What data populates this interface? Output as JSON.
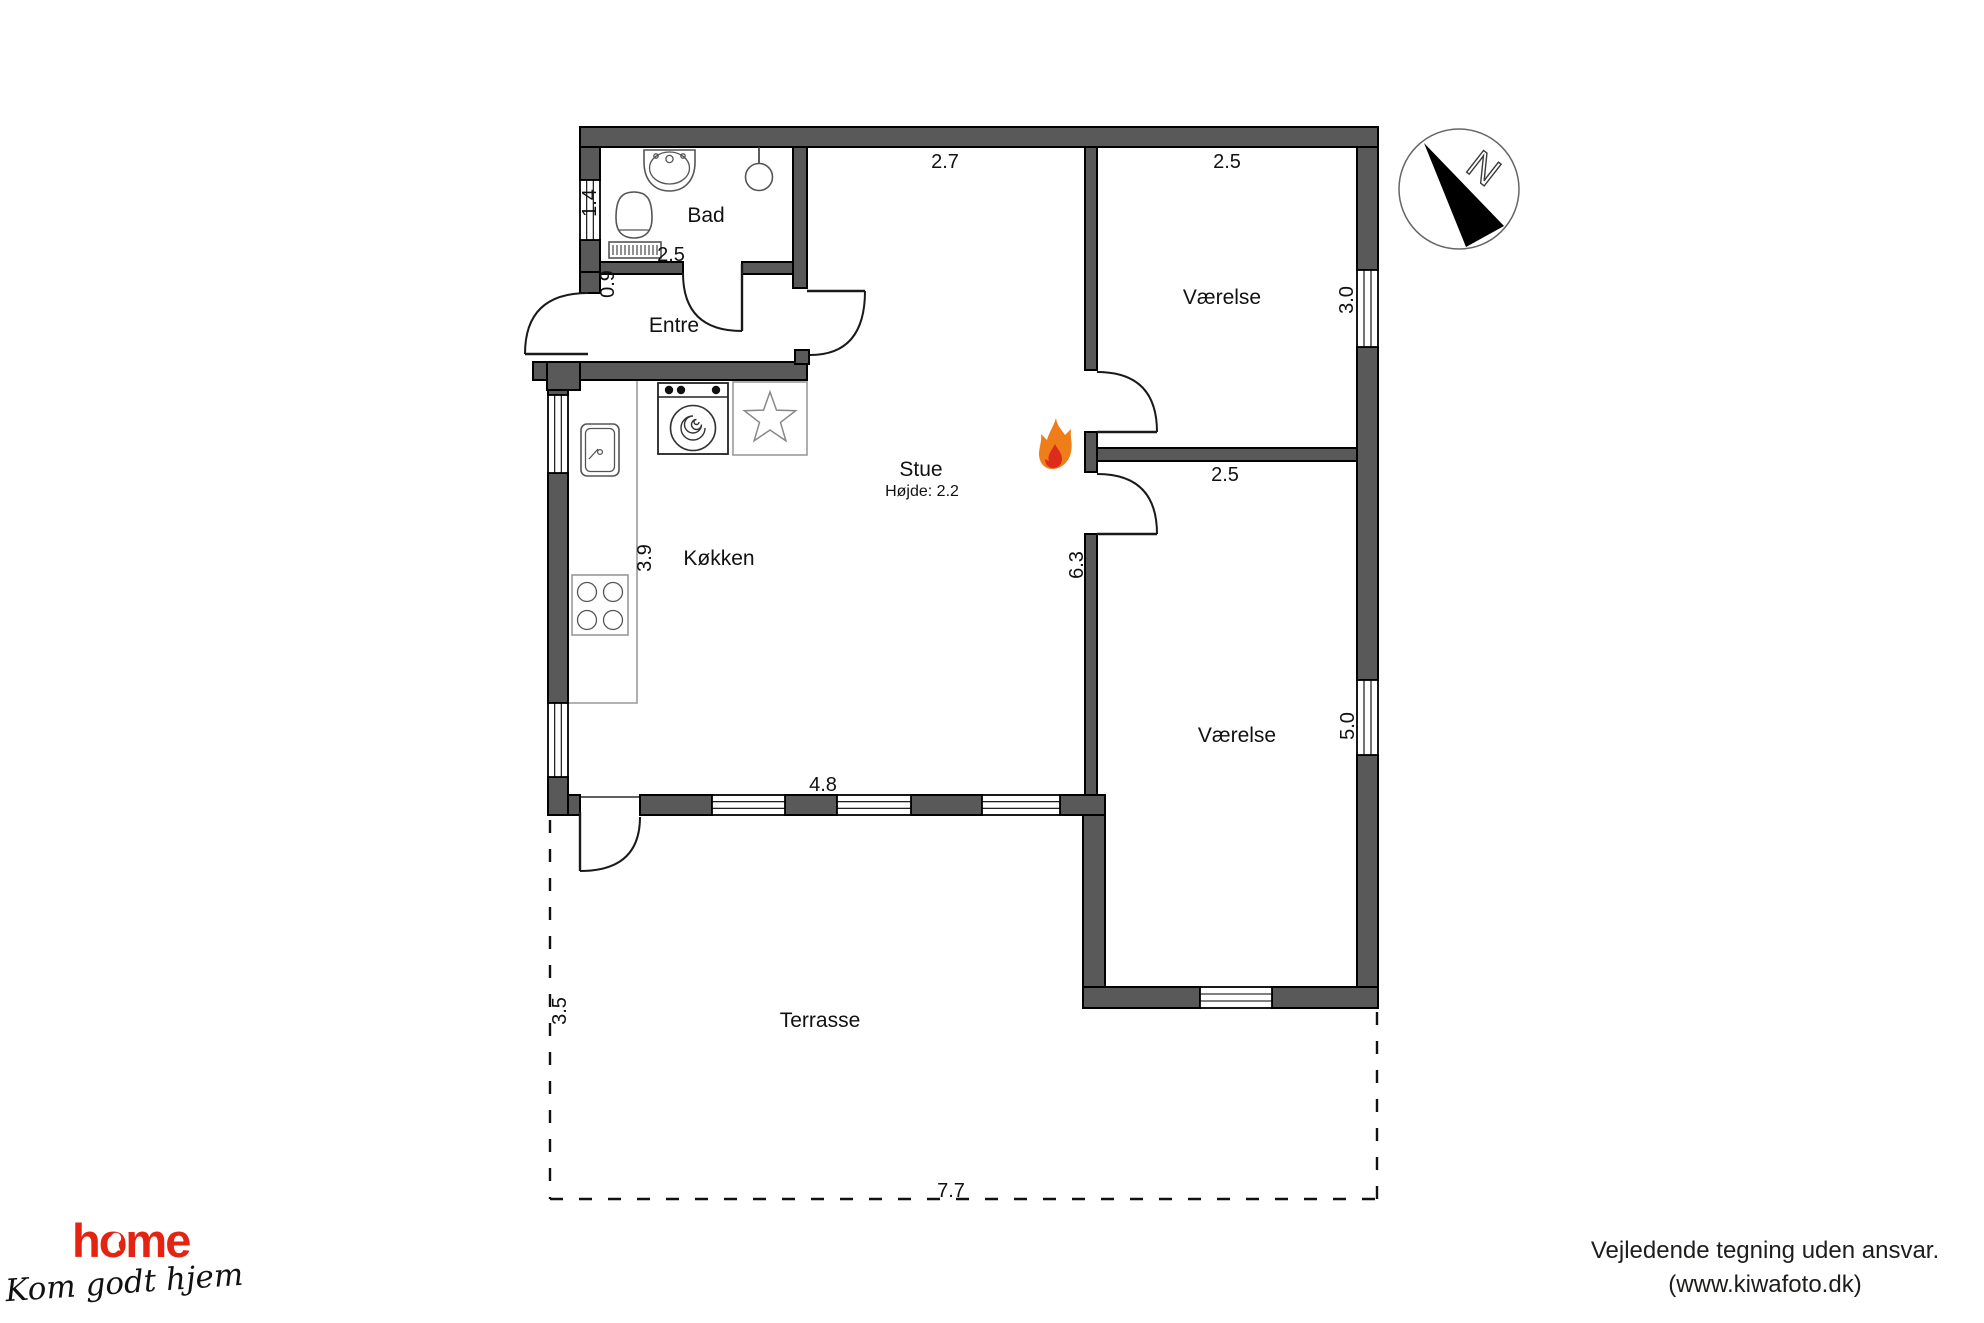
{
  "floor_plan": {
    "rooms": {
      "bad": "Bad",
      "entre": "Entre",
      "kokken": "Køkken",
      "stue": "Stue",
      "stue_height": "Højde: 2.2",
      "vaerelse_top": "Værelse",
      "vaerelse_bottom": "Værelse",
      "terrasse": "Terrasse"
    },
    "dimensions": {
      "stue_width": "2.7",
      "vaerelse_top_width": "2.5",
      "bad_window": "1.4",
      "bad_width": "2.5",
      "entre_door": "0.9",
      "vaerelse_top_depth": "3.0",
      "vaerelse_bottom_width": "2.5",
      "stue_depth": "6.3",
      "kokken_depth": "3.9",
      "vaerelse_bottom_depth": "5.0",
      "kokken_width": "4.8",
      "terrasse_depth": "3.5",
      "terrasse_width": "7.7"
    },
    "compass": {
      "north_label": "N"
    },
    "colors": {
      "wall": "#595959",
      "flame_outer": "#ef7d1a",
      "flame_inner": "#dd2c1c"
    }
  },
  "branding": {
    "logo": "home",
    "tagline": "Kom godt hjem",
    "logo_color": "#e42313"
  },
  "footer": {
    "line1": "Vejledende tegning uden ansvar.",
    "line2": "(www.kiwafoto.dk)"
  }
}
